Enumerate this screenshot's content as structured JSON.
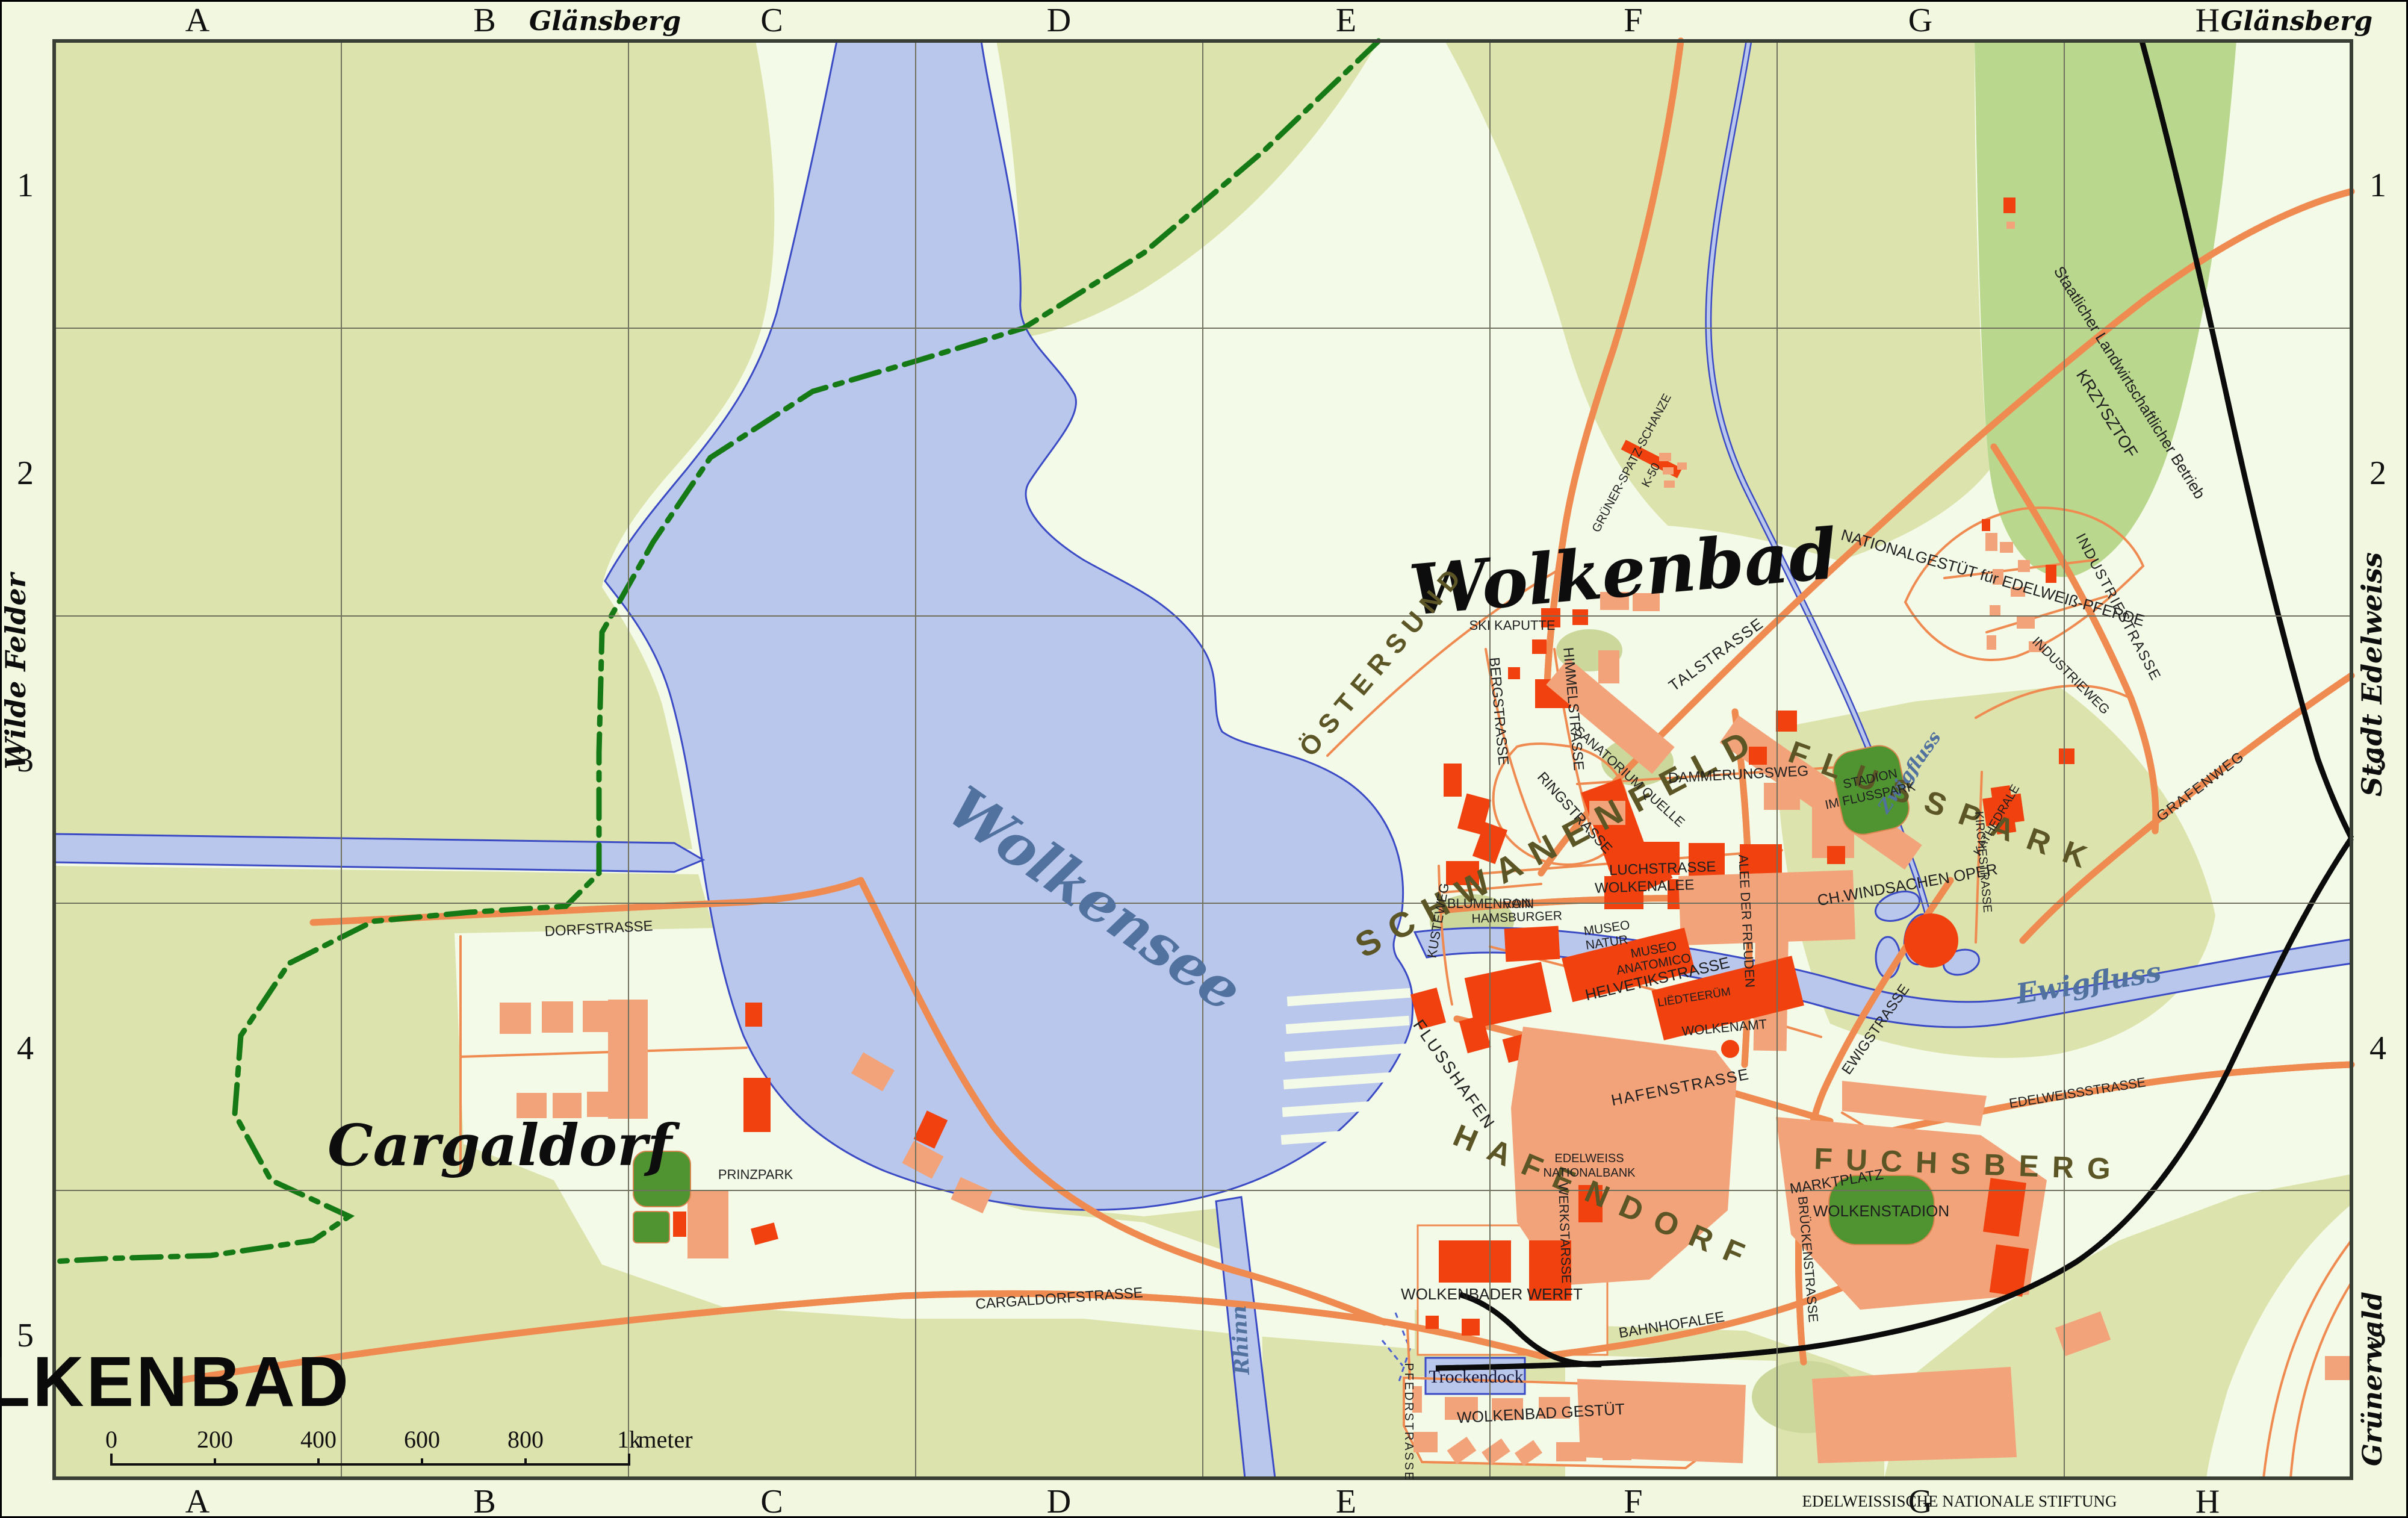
{
  "frame": {
    "columns": [
      "A",
      "B",
      "C",
      "D",
      "E",
      "F",
      "G",
      "H"
    ],
    "rows": [
      "1",
      "2",
      "3",
      "4",
      "5"
    ],
    "edge": {
      "top_label": "Glänsberg",
      "top_right_label": "Glänsberg",
      "left_label": "Wilde Felder",
      "right_upper_label": "Stadt Edelweiss",
      "right_lower_label": "Grünerwald"
    },
    "attribution": "EDELWEISSISCHE NATIONALE STIFTUNG"
  },
  "legend": {
    "title": "WOLKENBAD",
    "scale_ticks": [
      "0",
      "200",
      "400",
      "600",
      "800",
      "1k"
    ],
    "scale_unit": "meter"
  },
  "places": {
    "city": "Wolkenbad",
    "lake": "Wolkensee",
    "village": "Cargaldorf",
    "districts": {
      "ostersund": "ÖSTERSUND",
      "schwanenfeld": "SCHWANENFELD",
      "flusspark": "FLUSSPARK",
      "hafendorf": "HAFENDORF",
      "fuchsberg": "FUCHSBERG"
    }
  },
  "rivers": {
    "ewigfluss": "Ewigfluss",
    "zwigfluss": "Zwigfluss",
    "rhinn": "Rhinn"
  },
  "pois": {
    "ski_kaputte": "SKI KAPUTTE",
    "gruener_spatz": "GRÜNER-SPATZ-SCHANZE",
    "k50": "K-50",
    "sanatorium": "SANATORIUM QUELLE",
    "farm_1": "Staatlicher Landwirtschaftlicher Betrieb",
    "farm_2": "KRZYSZTOF",
    "gestuet_nord": "NATIONALGESTÜT für EDELWEIß-PFERDE",
    "stadion_1": "STADION",
    "stadion_2": "IM FLUSSPARK",
    "kathedrale": "KATHEDRALE",
    "oper": "CH.WINDSACHEN OPER",
    "museo_natur_1": "MUSEO",
    "museo_natur_2": "NATUR",
    "museo_anatomico_1": "MUSEO",
    "museo_anatomico_2": "ANATOMICO",
    "von_hamsburger_1": "VON",
    "von_hamsburger_2": "HAMSBURGER",
    "liedteeruem": "LIËDTEERÜM",
    "wolkenamt": "WOLKENAMT",
    "nationalbank_1": "EDELWEISS",
    "nationalbank_2": "NATIONALBANK",
    "flusshafen": "FLUSSHAFEN",
    "werft": "WOLKENBADER WERFT",
    "trockendock": "Trockendock",
    "wolkenstadion": "WOLKENSTADION",
    "prinzpark": "PRINZPARK",
    "gestuet_sued": "WOLKENBAD GESTÜT"
  },
  "streets": {
    "dorfstrasse": "DORFSTRASSE",
    "cargaldorfstrasse": "CARGALDORFSTRASSE",
    "pfedrstrasse": "PFEDRSTRASSE",
    "talstrasse": "TALSTRASSE",
    "bergstrasse": "BERGSTRASSE",
    "himmelstrasse": "HIMMELSTRASSE",
    "ringstrasse": "RINGSTRASSE",
    "dammerungsweg": "DAMMERUNGSWEG",
    "luchstrasse": "LUCHSTRASSE",
    "blumenrain": "BLUMENRAIN",
    "kusteweg": "KUSTEWEG",
    "wolkenalee": "WOLKENALEE",
    "alee_der_freuden": "ALEE DER FREUDEN",
    "helvetikstrasse": "HELVETIKSTRASSE",
    "hafenstrasse": "HAFENSTRASSE",
    "werkstarsse": "WERKSTARSSE",
    "bahnhofalee": "BAHNHOFALEE",
    "marktplatz": "MARKTPLATZ",
    "edelweissstrasse": "EDELWEISSSTRASSE",
    "ewigstrasse": "EWIGSTRASSE",
    "brueckenstrasse": "BRÜCKENSTRASSE",
    "kirchestrasse": "KIRCHESTRASSE",
    "grafenweg": "GRAFENWEG",
    "industriestrasse": "INDUSTRIESTRASSE",
    "industrieweg": "INDUSTRIEWEG"
  },
  "colors": {
    "paper": "#f2f8e0",
    "urban": "#f4fae8",
    "fields": "#dce3ad",
    "forest": "#b9d88e",
    "park_green": "#4f9431",
    "water_fill": "#b9c7ec",
    "water_stroke": "#3a49c4",
    "water_label": "#51719e",
    "road": "#ef8a50",
    "building_common": "#f3a379",
    "building_public": "#f0410e",
    "district_label": "#5c5526",
    "boundary_green": "#157a15",
    "railway": "#0b0b0b"
  }
}
